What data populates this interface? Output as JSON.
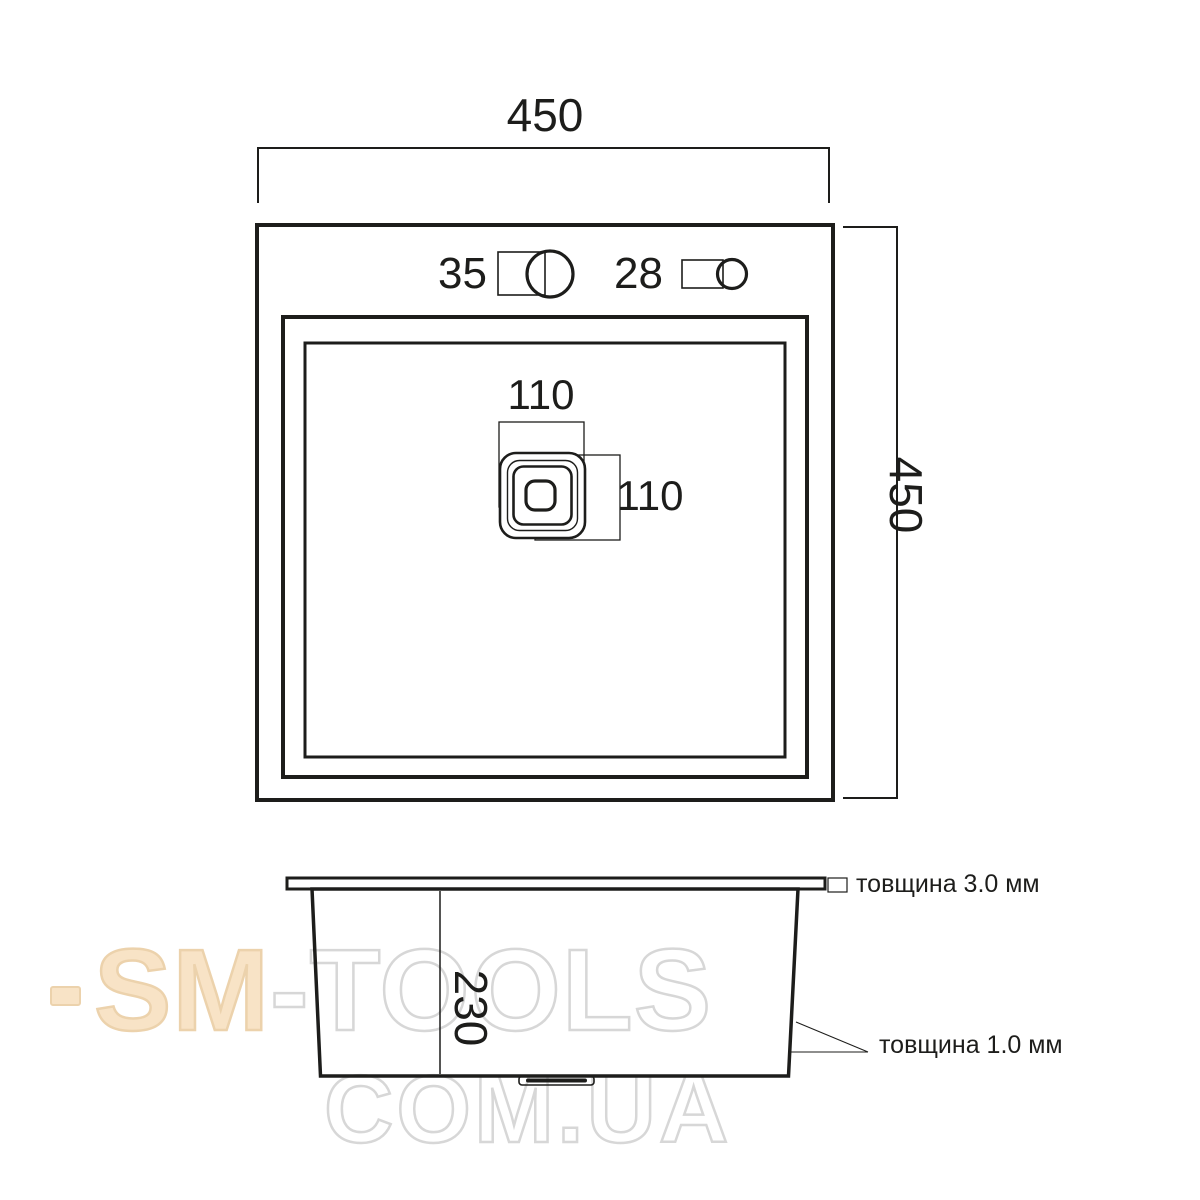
{
  "drawing": {
    "top_view": {
      "width_label": "450",
      "height_label": "450",
      "faucet_hole_label": "35",
      "dispenser_hole_label": "28",
      "drain_width_label": "110",
      "drain_height_label": "110"
    },
    "side_view": {
      "depth_label": "230",
      "rim_thickness_label": "товщина 3.0 мм",
      "wall_thickness_label": "товщина 1.0 мм"
    },
    "watermark": {
      "brand_left": "SM",
      "brand_right": "-TOOLS",
      "domain_line": "COM.UA"
    },
    "colors": {
      "line": "#1d1d1b",
      "watermark_peach_fill": "#f8e3c6",
      "watermark_peach_stroke": "#ecd2ac",
      "watermark_gray_stroke": "#d7d7d7"
    }
  }
}
